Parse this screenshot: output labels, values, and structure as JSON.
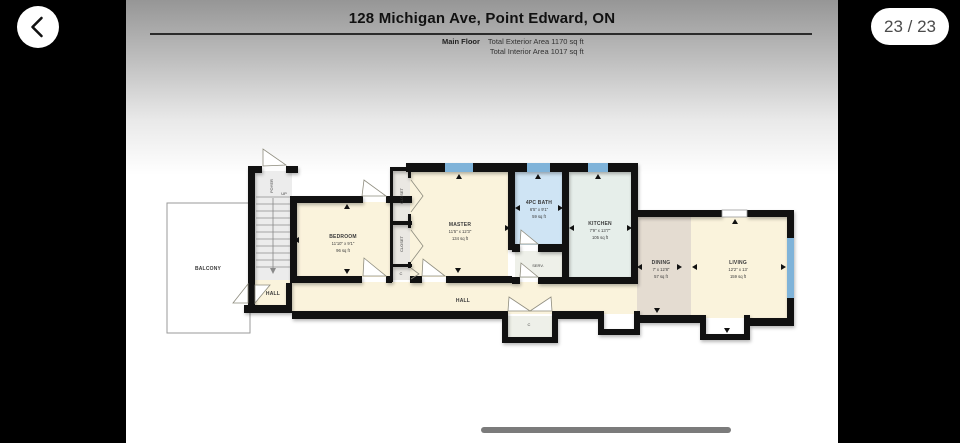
{
  "viewer": {
    "counter": "23 / 23",
    "back_icon": "chevron-left"
  },
  "header": {
    "title": "128 Michigan Ave, Point Edward, ON",
    "floor_label": "Main Floor",
    "stats": [
      "Total Exterior Area 1170 sq ft",
      "Total Interior Area 1017 sq ft"
    ]
  },
  "floorplan": {
    "rooms": {
      "balcony": {
        "name": "BALCONY"
      },
      "foyer": {
        "name": "FOYER",
        "up": "UP"
      },
      "hall_left": {
        "name": "HALL"
      },
      "hall_main": {
        "name": "HALL"
      },
      "bedroom": {
        "name": "BEDROOM",
        "dims": "11'10\" x 9'1\"",
        "area": "96 sq ft"
      },
      "closet_top": {
        "name": "CLOSET"
      },
      "closet_mid": {
        "name": "CLOSET"
      },
      "closet_small": {
        "name": "C"
      },
      "hall_closet": {
        "name": "C"
      },
      "master": {
        "name": "MASTER",
        "dims": "11'5\" x 12'3\"",
        "area": "134 sq ft"
      },
      "bath": {
        "name": "4PC BATH",
        "dims": "6'5\" x 9'1\"",
        "area": "59 sq ft"
      },
      "serv": {
        "name": "SERV."
      },
      "kitchen": {
        "name": "KITCHEN",
        "dims": "7'9\" x 13'7\"",
        "area": "105 sq ft"
      },
      "dining": {
        "name": "DINING",
        "dims": "7' x 12'8\"",
        "area": "57 sq ft"
      },
      "living": {
        "name": "LIVING",
        "dims": "12'2\" x 13'",
        "area": "159 sq ft"
      }
    },
    "colors": {
      "wall": "#111111",
      "cream": "#faf3dc",
      "bath_blue": "#cfe4f4",
      "kitchen_green": "#e6eeea",
      "dining_tan": "#e4dcd1",
      "closet_gray": "#eae8e3",
      "serv_pale": "#eef0e9",
      "stairs_gray": "#ececec",
      "window_blue": "#7fb3d9"
    }
  }
}
